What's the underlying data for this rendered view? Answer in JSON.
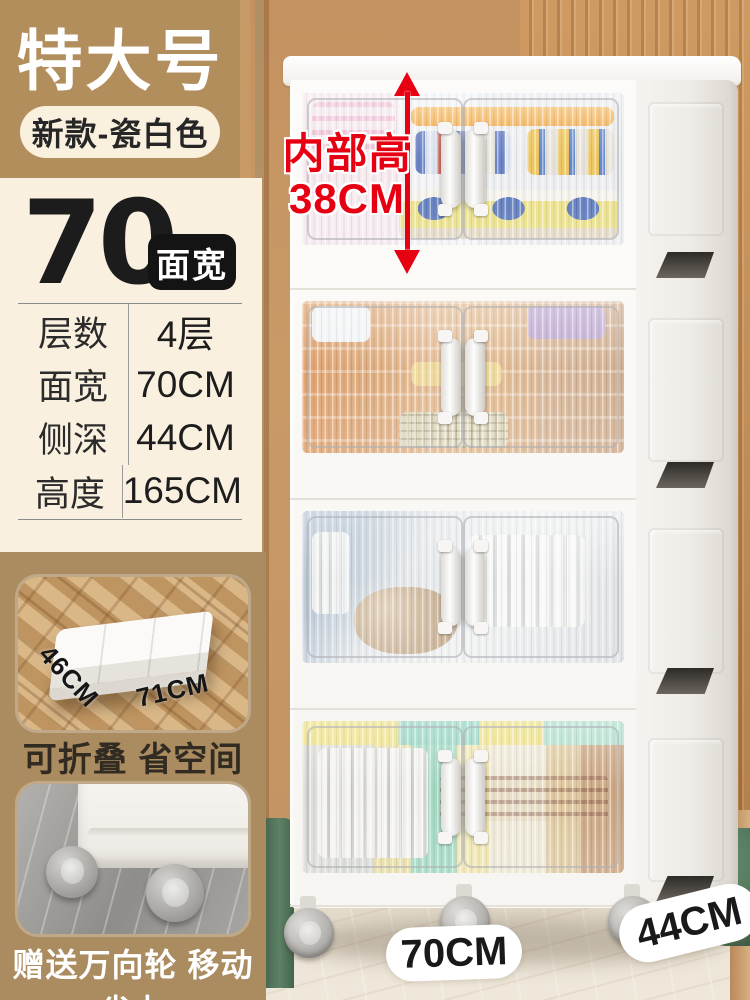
{
  "left_panel": {
    "size_badge": "特大号",
    "variant_badge": "新款-瓷白色",
    "width_value": "70",
    "width_tag": "面宽",
    "specs": [
      {
        "label": "层数",
        "value": "4层"
      },
      {
        "label": "面宽",
        "value": "70CM"
      },
      {
        "label": "侧深",
        "value": "44CM"
      },
      {
        "label": "高度",
        "value": "165CM"
      }
    ],
    "folded_photo": {
      "depth_label": "46CM",
      "width_label": "71CM",
      "caption": "可折叠 省空间"
    },
    "wheels_photo": {
      "caption": "赠送万向轮 移动省力"
    }
  },
  "scene": {
    "inner_height_annotation": {
      "line1": "内部高",
      "line2": "38CM"
    },
    "floor_width_label": "70CM",
    "floor_depth_label": "44CM",
    "tier_count": 4
  },
  "colors": {
    "accent_red": "#e60012",
    "badge_tan": "#b18e5b",
    "panel_cream": "#faf0e0",
    "section_tan": "#ab8c60",
    "ink": "#1c1c1c"
  }
}
